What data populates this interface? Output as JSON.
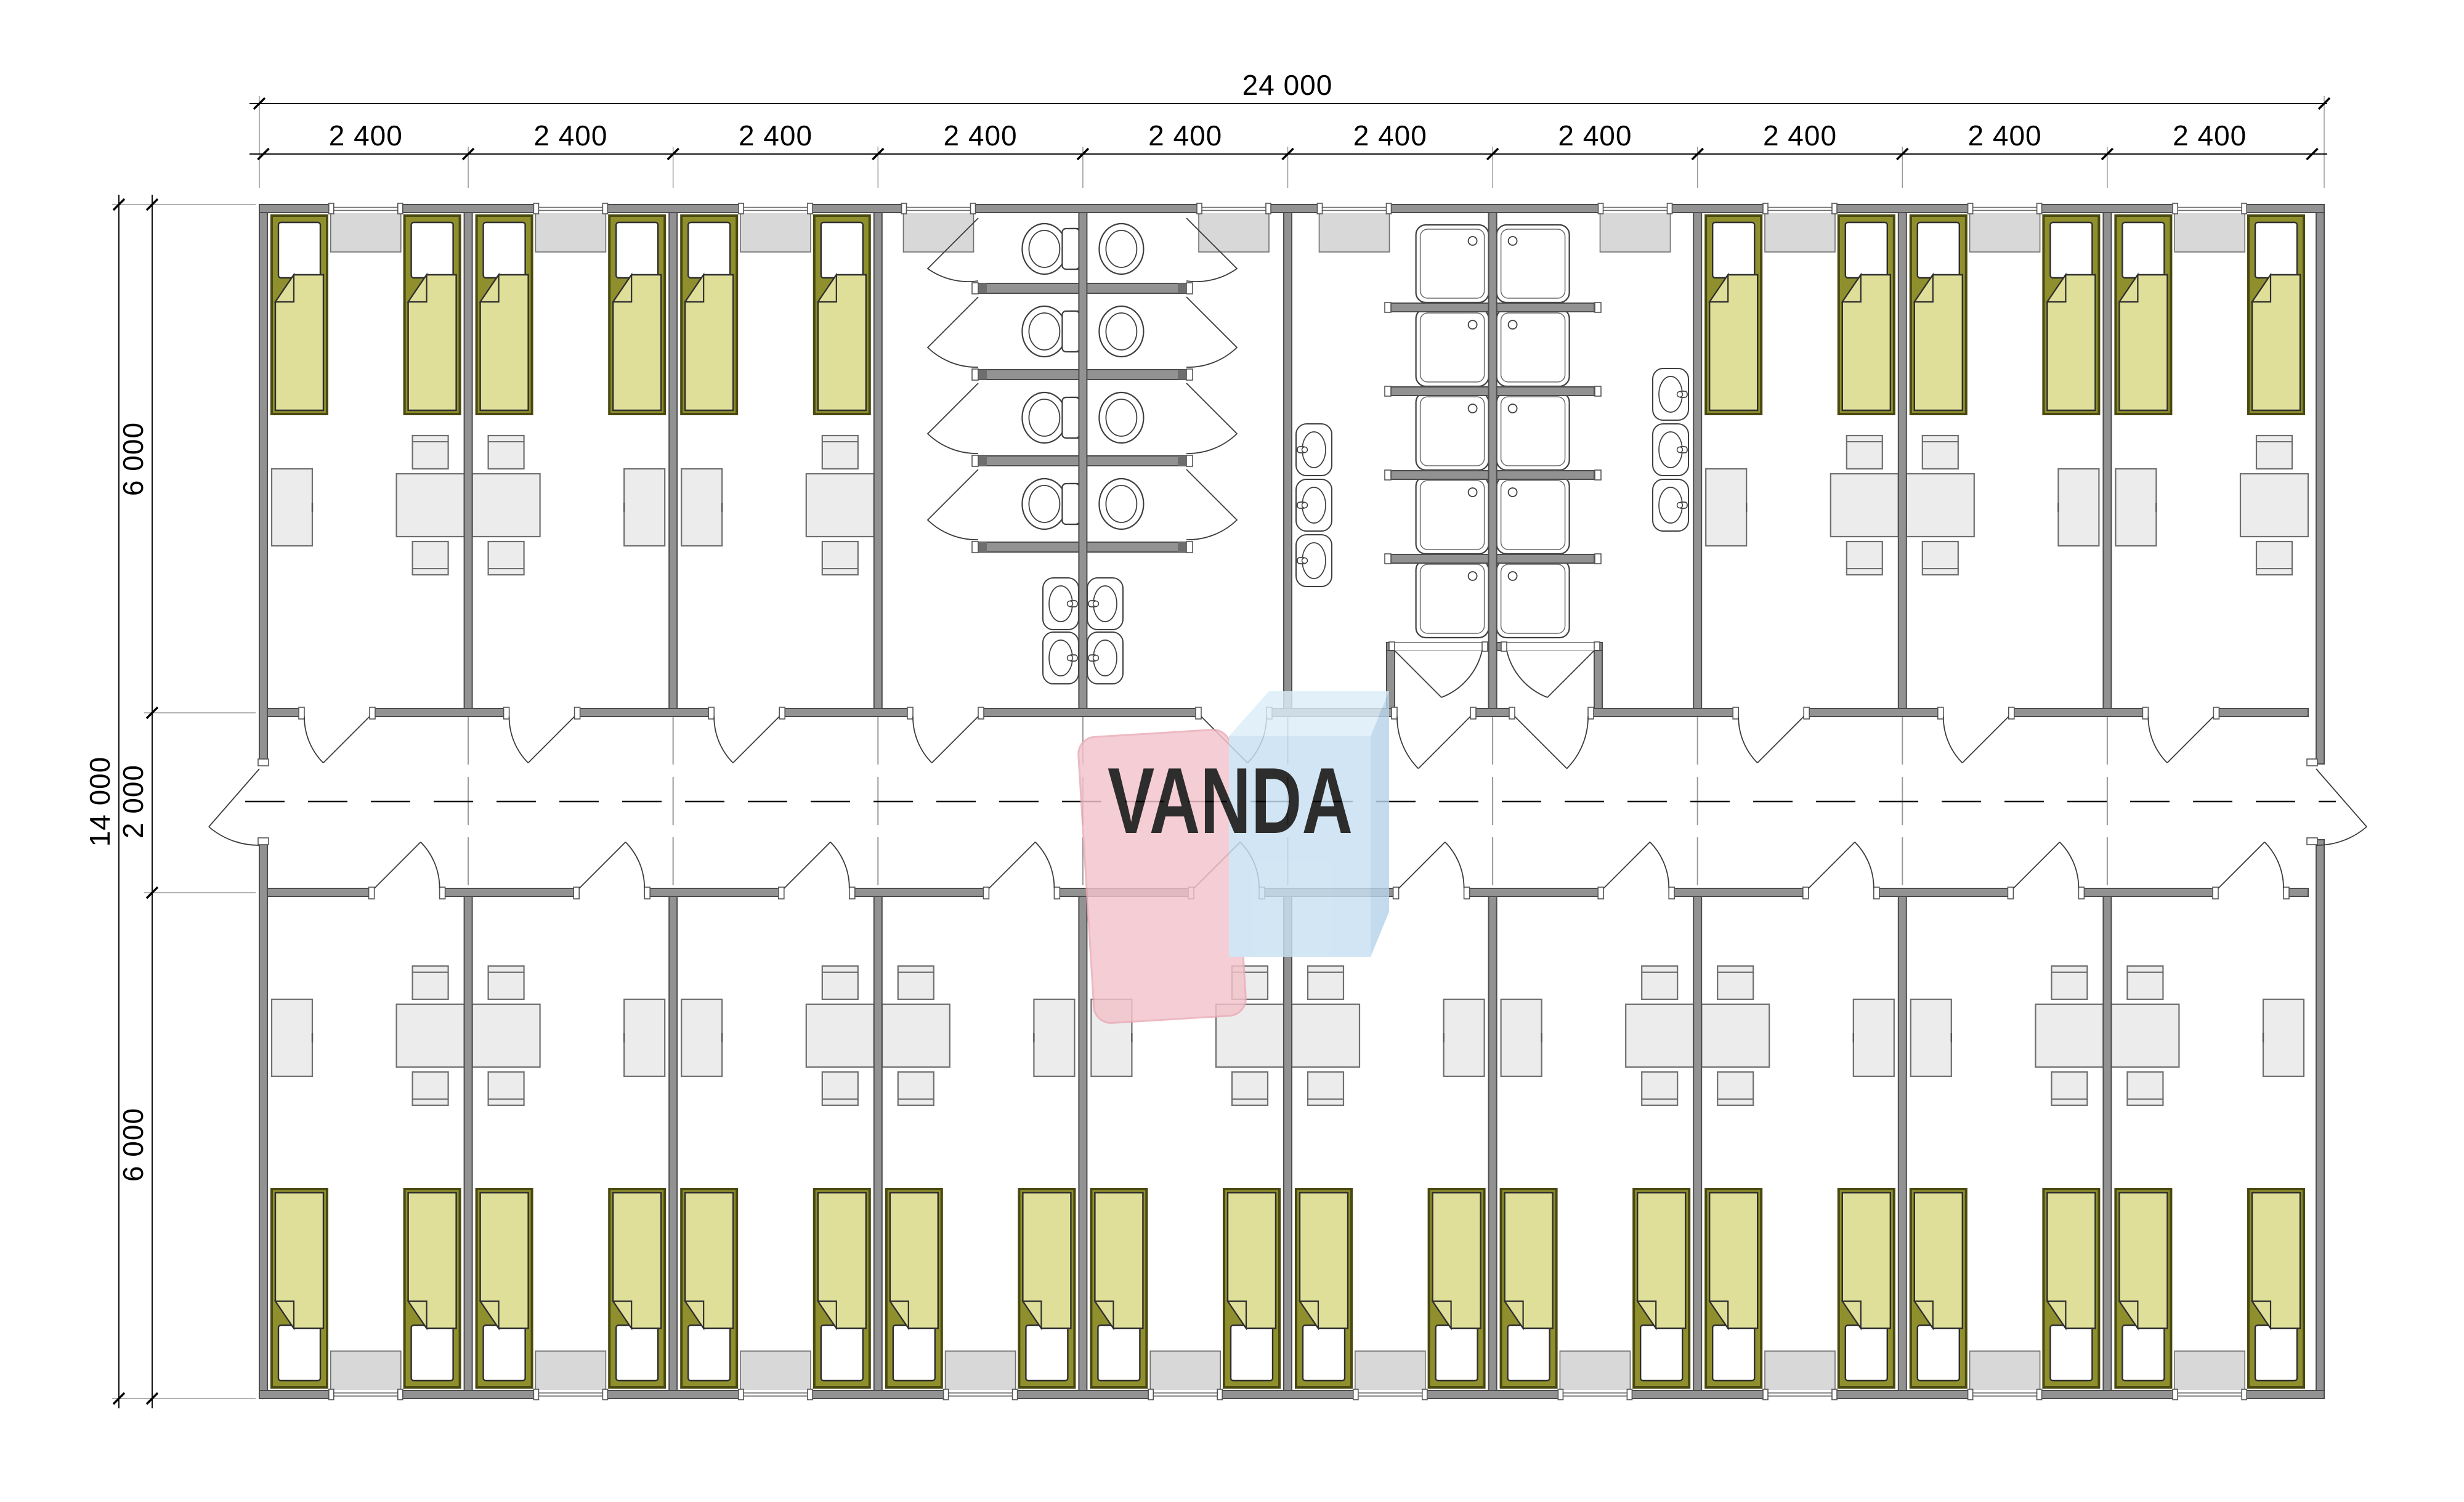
{
  "dimensions": {
    "top_total": "24 000",
    "top_modules": [
      "2 400",
      "2 400",
      "2 400",
      "2 400",
      "2 400",
      "2 400",
      "2 400",
      "2 400",
      "2 400",
      "2 400"
    ],
    "left_total": "14 000",
    "left_segments": [
      "6 000",
      "2 000",
      "6 000"
    ]
  },
  "watermark": {
    "text": "VANDA",
    "pink": "#f3c3cb",
    "pink_edge": "#eaaab6",
    "blue_front": "#c8e0f2",
    "blue_top": "#dcedf8",
    "blue_side": "#b7d4e9",
    "text_color": "#ffffff"
  },
  "colors": {
    "wall_fill": "#929292",
    "wall_edge": "#4d4d4d",
    "fixture_line": "#3f3f3f",
    "furniture_fill": "#ececec",
    "furniture_edge": "#6f6f6f",
    "sill_fill": "#d8d8d8",
    "sill_edge": "#707070",
    "bed_frame": "#8f8f2e",
    "bed_frame_edge": "#494910",
    "bed_blanket": "#dfdf99",
    "bed_line": "#2f2f2f",
    "grid_line": "#999999"
  },
  "layout_data": {
    "top_rooms": [
      {
        "module": 0,
        "wardrobe": "left",
        "table": "right"
      },
      {
        "module": 1,
        "wardrobe": "right",
        "table": "left"
      },
      {
        "module": 2,
        "wardrobe": "left",
        "table": "right"
      },
      {
        "module": 7,
        "wardrobe": "left",
        "table": "right"
      },
      {
        "module": 8,
        "wardrobe": "right",
        "table": "left"
      },
      {
        "module": 9,
        "wardrobe": "left",
        "table": "right"
      }
    ],
    "bottom_rooms": [
      {
        "module": 0,
        "wardrobe": "left",
        "table": "right"
      },
      {
        "module": 1,
        "wardrobe": "right",
        "table": "left"
      },
      {
        "module": 2,
        "wardrobe": "left",
        "table": "right"
      },
      {
        "module": 3,
        "wardrobe": "right",
        "table": "left"
      },
      {
        "module": 4,
        "wardrobe": "left",
        "table": "right"
      },
      {
        "module": 5,
        "wardrobe": "right",
        "table": "left"
      },
      {
        "module": 6,
        "wardrobe": "left",
        "table": "right"
      },
      {
        "module": 7,
        "wardrobe": "right",
        "table": "left"
      },
      {
        "module": 8,
        "wardrobe": "left",
        "table": "right"
      },
      {
        "module": 9,
        "wardrobe": "right",
        "table": "left"
      }
    ],
    "toilet_block": {
      "rooms": 2,
      "stall_rows": 4,
      "toilets": 8,
      "sinks": 4
    },
    "shower_block": {
      "rooms": 2,
      "trays_per_room": 5,
      "sinks_per_room": 3
    },
    "beds_total": 32,
    "top_window_centers": [
      593.8,
      926.4,
      1259,
      1523.5,
      2003,
      2198.5,
      2654.5,
      2922,
      3254.6,
      3587.2
    ],
    "bottom_window_centers": [
      593.8,
      926.4,
      1259,
      1591.6,
      1924.2,
      2256.8,
      2589.4,
      2922,
      3254.6,
      3587.2
    ]
  }
}
